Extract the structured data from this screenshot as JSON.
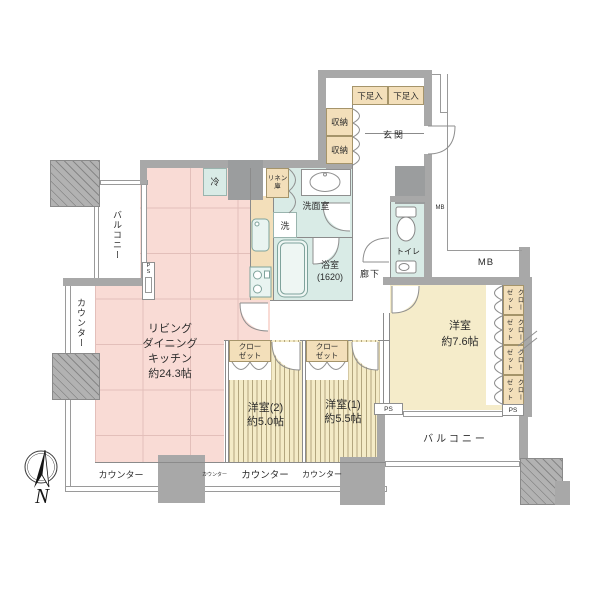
{
  "palette": {
    "wall_gray": "#a8a8a8",
    "ldk_pink": "#f9dbd5",
    "wet_cyan": "#d9ebe6",
    "closet_tan": "#f3dfba",
    "bedroom_cream": "#f5ecca",
    "stripe_tan": "#b3a67f",
    "line_gray": "#8f8f8f"
  },
  "rooms": {
    "ldk": {
      "l1": "リビング",
      "l2": "ダイニング",
      "l3": "キッチン",
      "l4": "約24.3帖"
    },
    "bedroom2": {
      "l1": "洋室(2)",
      "l2": "約5.0帖"
    },
    "bedroom1": {
      "l1": "洋室(1)",
      "l2": "約5.5帖"
    },
    "bedroom_main": {
      "l1": "洋室",
      "l2": "約7.6帖"
    },
    "bath": {
      "l1": "浴室",
      "l2": "(1620)"
    },
    "washroom": "洗面室",
    "toilet": "トイレ",
    "entrance": "玄関",
    "hall": "廊下",
    "balcony_left": "バルコニー",
    "balcony_bottom": "バルコニー"
  },
  "fixtures": {
    "fridge": "冷",
    "linen_l1": "リネン",
    "linen_l2": "庫",
    "washer": "洗",
    "shoe_storage": "下足入",
    "storage": "収納",
    "closet_l1": "クロー",
    "closet_l2": "ゼット"
  },
  "counters": {
    "label": "カウンター"
  },
  "shafts": {
    "ps": "PS",
    "mb": "MB"
  },
  "compass": {
    "north": "N"
  }
}
